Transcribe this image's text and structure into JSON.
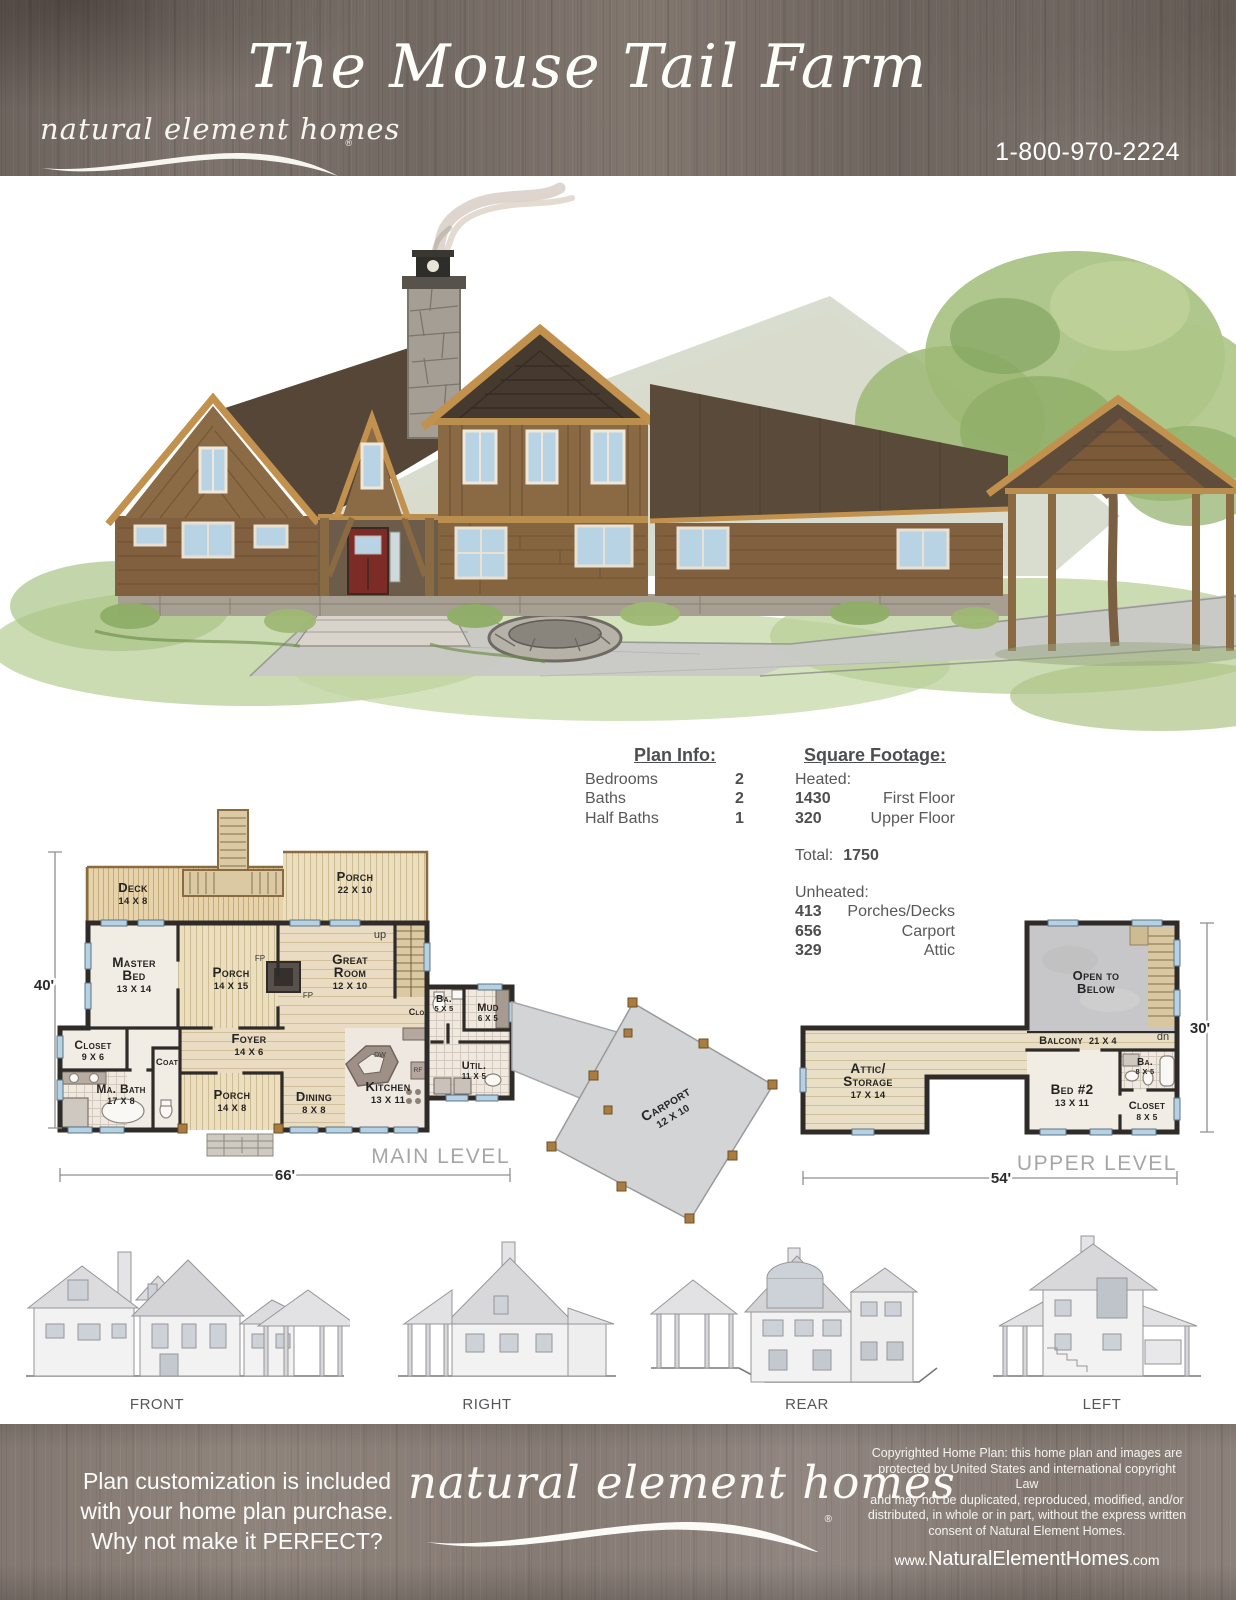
{
  "header": {
    "logo": "natural element homes",
    "reg": "®",
    "title": "The Mouse Tail Farm",
    "phone": "1-800-970-2224"
  },
  "plan_info": {
    "heading": "Plan Info:",
    "rows": [
      {
        "label": "Bedrooms",
        "value": "2"
      },
      {
        "label": "Baths",
        "value": "2"
      },
      {
        "label": "Half Baths",
        "value": "1"
      }
    ]
  },
  "square_footage": {
    "heading": "Square Footage:",
    "heated_label": "Heated:",
    "heated_rows": [
      {
        "value": "1430",
        "label": "First Floor"
      },
      {
        "value": "320",
        "label": "Upper Floor"
      }
    ],
    "total_label": "Total:",
    "total_value": "1750",
    "unheated_label": "Unheated:",
    "unheated_rows": [
      {
        "value": "413",
        "label": "Porches/Decks"
      },
      {
        "value": "656",
        "label": "Carport"
      },
      {
        "value": "329",
        "label": "Attic"
      }
    ]
  },
  "main_level": {
    "level_label": "MAIN LEVEL",
    "dims": {
      "width": "66'",
      "height": "40'"
    },
    "rooms": {
      "deck": {
        "line1": "Deck",
        "size": "14 X 8"
      },
      "porch_top": {
        "line1": "Porch",
        "size": "22 X 10"
      },
      "master": {
        "line1": "Master",
        "line2": "Bed",
        "size": "13 X 14"
      },
      "porch_mid": {
        "line1": "Porch",
        "size": "14 X 15"
      },
      "great": {
        "line1": "Great",
        "line2": "Room",
        "size": "12 X 10"
      },
      "closet": {
        "line1": "Closet",
        "size": "9 X 6"
      },
      "coat": {
        "line1": "Coat"
      },
      "foyer": {
        "line1": "Foyer",
        "size": "14 X 6"
      },
      "mabath": {
        "line1": "Ma. Bath",
        "size": "17 X 8"
      },
      "porch_b": {
        "line1": "Porch",
        "size": "14 X 8"
      },
      "dining": {
        "line1": "Dining",
        "size": "8 X 8"
      },
      "kitchen": {
        "line1": "Kitchen",
        "size": "13 X 11"
      },
      "ba": {
        "line1": "Ba.",
        "size": "5 X 5"
      },
      "mud": {
        "line1": "Mud",
        "size": "6 X 5"
      },
      "util": {
        "line1": "Util.",
        "size": "11 X 5"
      },
      "clo": {
        "line1": "Clo."
      },
      "carport": {
        "line1": "Carport",
        "size": "12 X 10"
      }
    },
    "ann": {
      "up": "up",
      "fp": "FP",
      "dw": "DW",
      "rf": "RF"
    }
  },
  "upper_level": {
    "level_label": "UPPER LEVEL",
    "dims": {
      "width": "54'",
      "height": "30'"
    },
    "rooms": {
      "open": {
        "line1": "Open to",
        "line2": "Below"
      },
      "balcony": {
        "line1": "Balcony",
        "size": "21 X 4"
      },
      "attic": {
        "line1": "Attic/",
        "line2": "Storage",
        "size": "17 X 14"
      },
      "bed2": {
        "line1": "Bed #2",
        "size": "13 X 11"
      },
      "ba": {
        "line1": "Ba.",
        "size": "8 X 5"
      },
      "closet": {
        "line1": "Closet",
        "size": "8 X 5"
      }
    },
    "ann": {
      "dn": "dn"
    }
  },
  "elevations": [
    "FRONT",
    "RIGHT",
    "REAR",
    "LEFT"
  ],
  "footer": {
    "promo": [
      "Plan customization is included",
      "with your home plan purchase.",
      "Why not make it PERFECT?"
    ],
    "logo": "natural element homes",
    "reg": "®",
    "copyright": [
      "Copyrighted Home Plan: this home plan and images are",
      "protected by United States and international copyright Law",
      "and may not be duplicated, reproduced, modified, and/or",
      "distributed, in whole or in part, without the express written",
      "consent of Natural Element Homes."
    ],
    "website": {
      "prefix": "www.",
      "name": "NaturalElementHomes",
      "suffix": ".com"
    }
  },
  "colors": {
    "header_wood": "#7b716b",
    "footer_wood": "#8a7f78",
    "accent_wood": "#8a6a3f",
    "wall": "#2e2b29",
    "window": "#b5d2e4",
    "deck": "#e6d3ab",
    "porch": "#ecdfc0",
    "open_below": "#c7c7c9",
    "carport": "#d3d4d6"
  }
}
